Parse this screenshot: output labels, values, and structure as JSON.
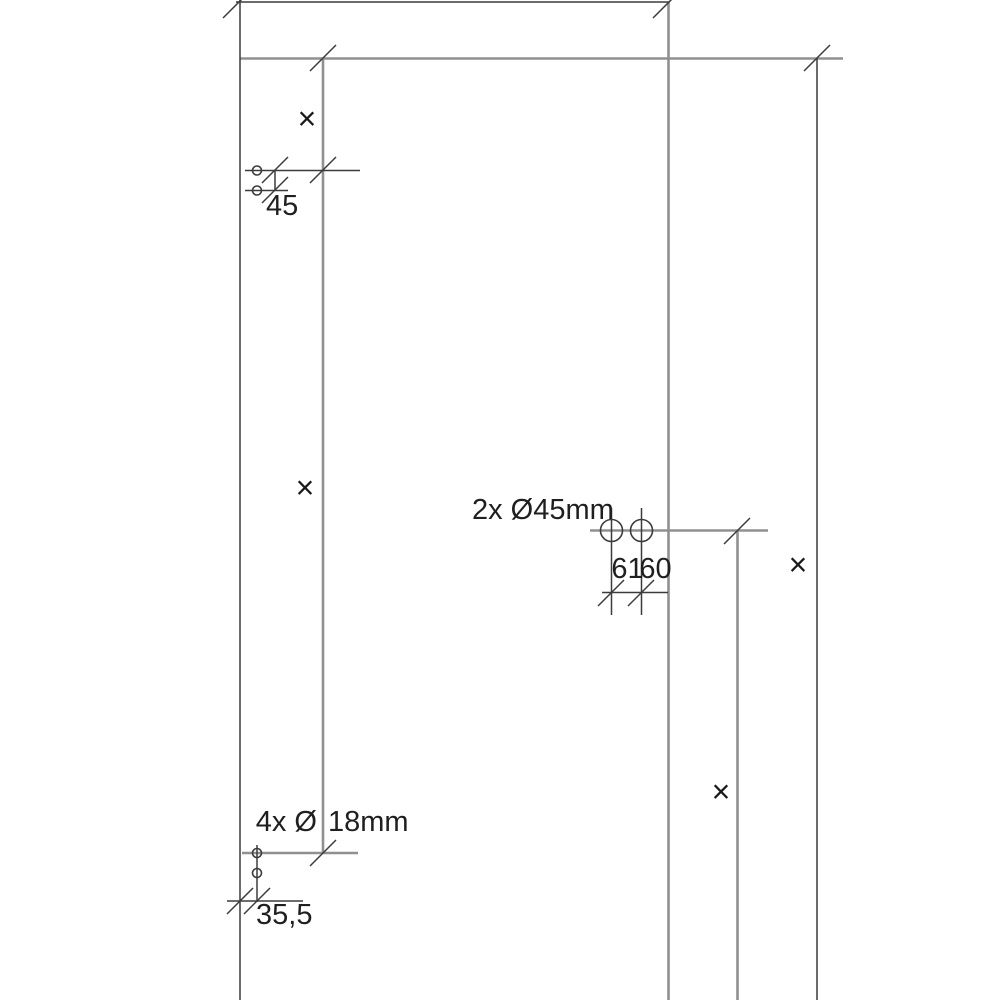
{
  "colors": {
    "background": "#ffffff",
    "panel_edge_line": "#909090",
    "dimension_line": "#3c3c3c",
    "text": "#1f1f1f"
  },
  "labels": {
    "dim_top_left": "45",
    "large_holes": "2x Ø45mm",
    "hole_spacing_left": "61",
    "hole_spacing_right": "60",
    "small_holes_prefix": "4x Ø",
    "small_holes_suffix": "18mm",
    "dim_bottom_left": "35,5"
  },
  "marker_glyph": "×"
}
